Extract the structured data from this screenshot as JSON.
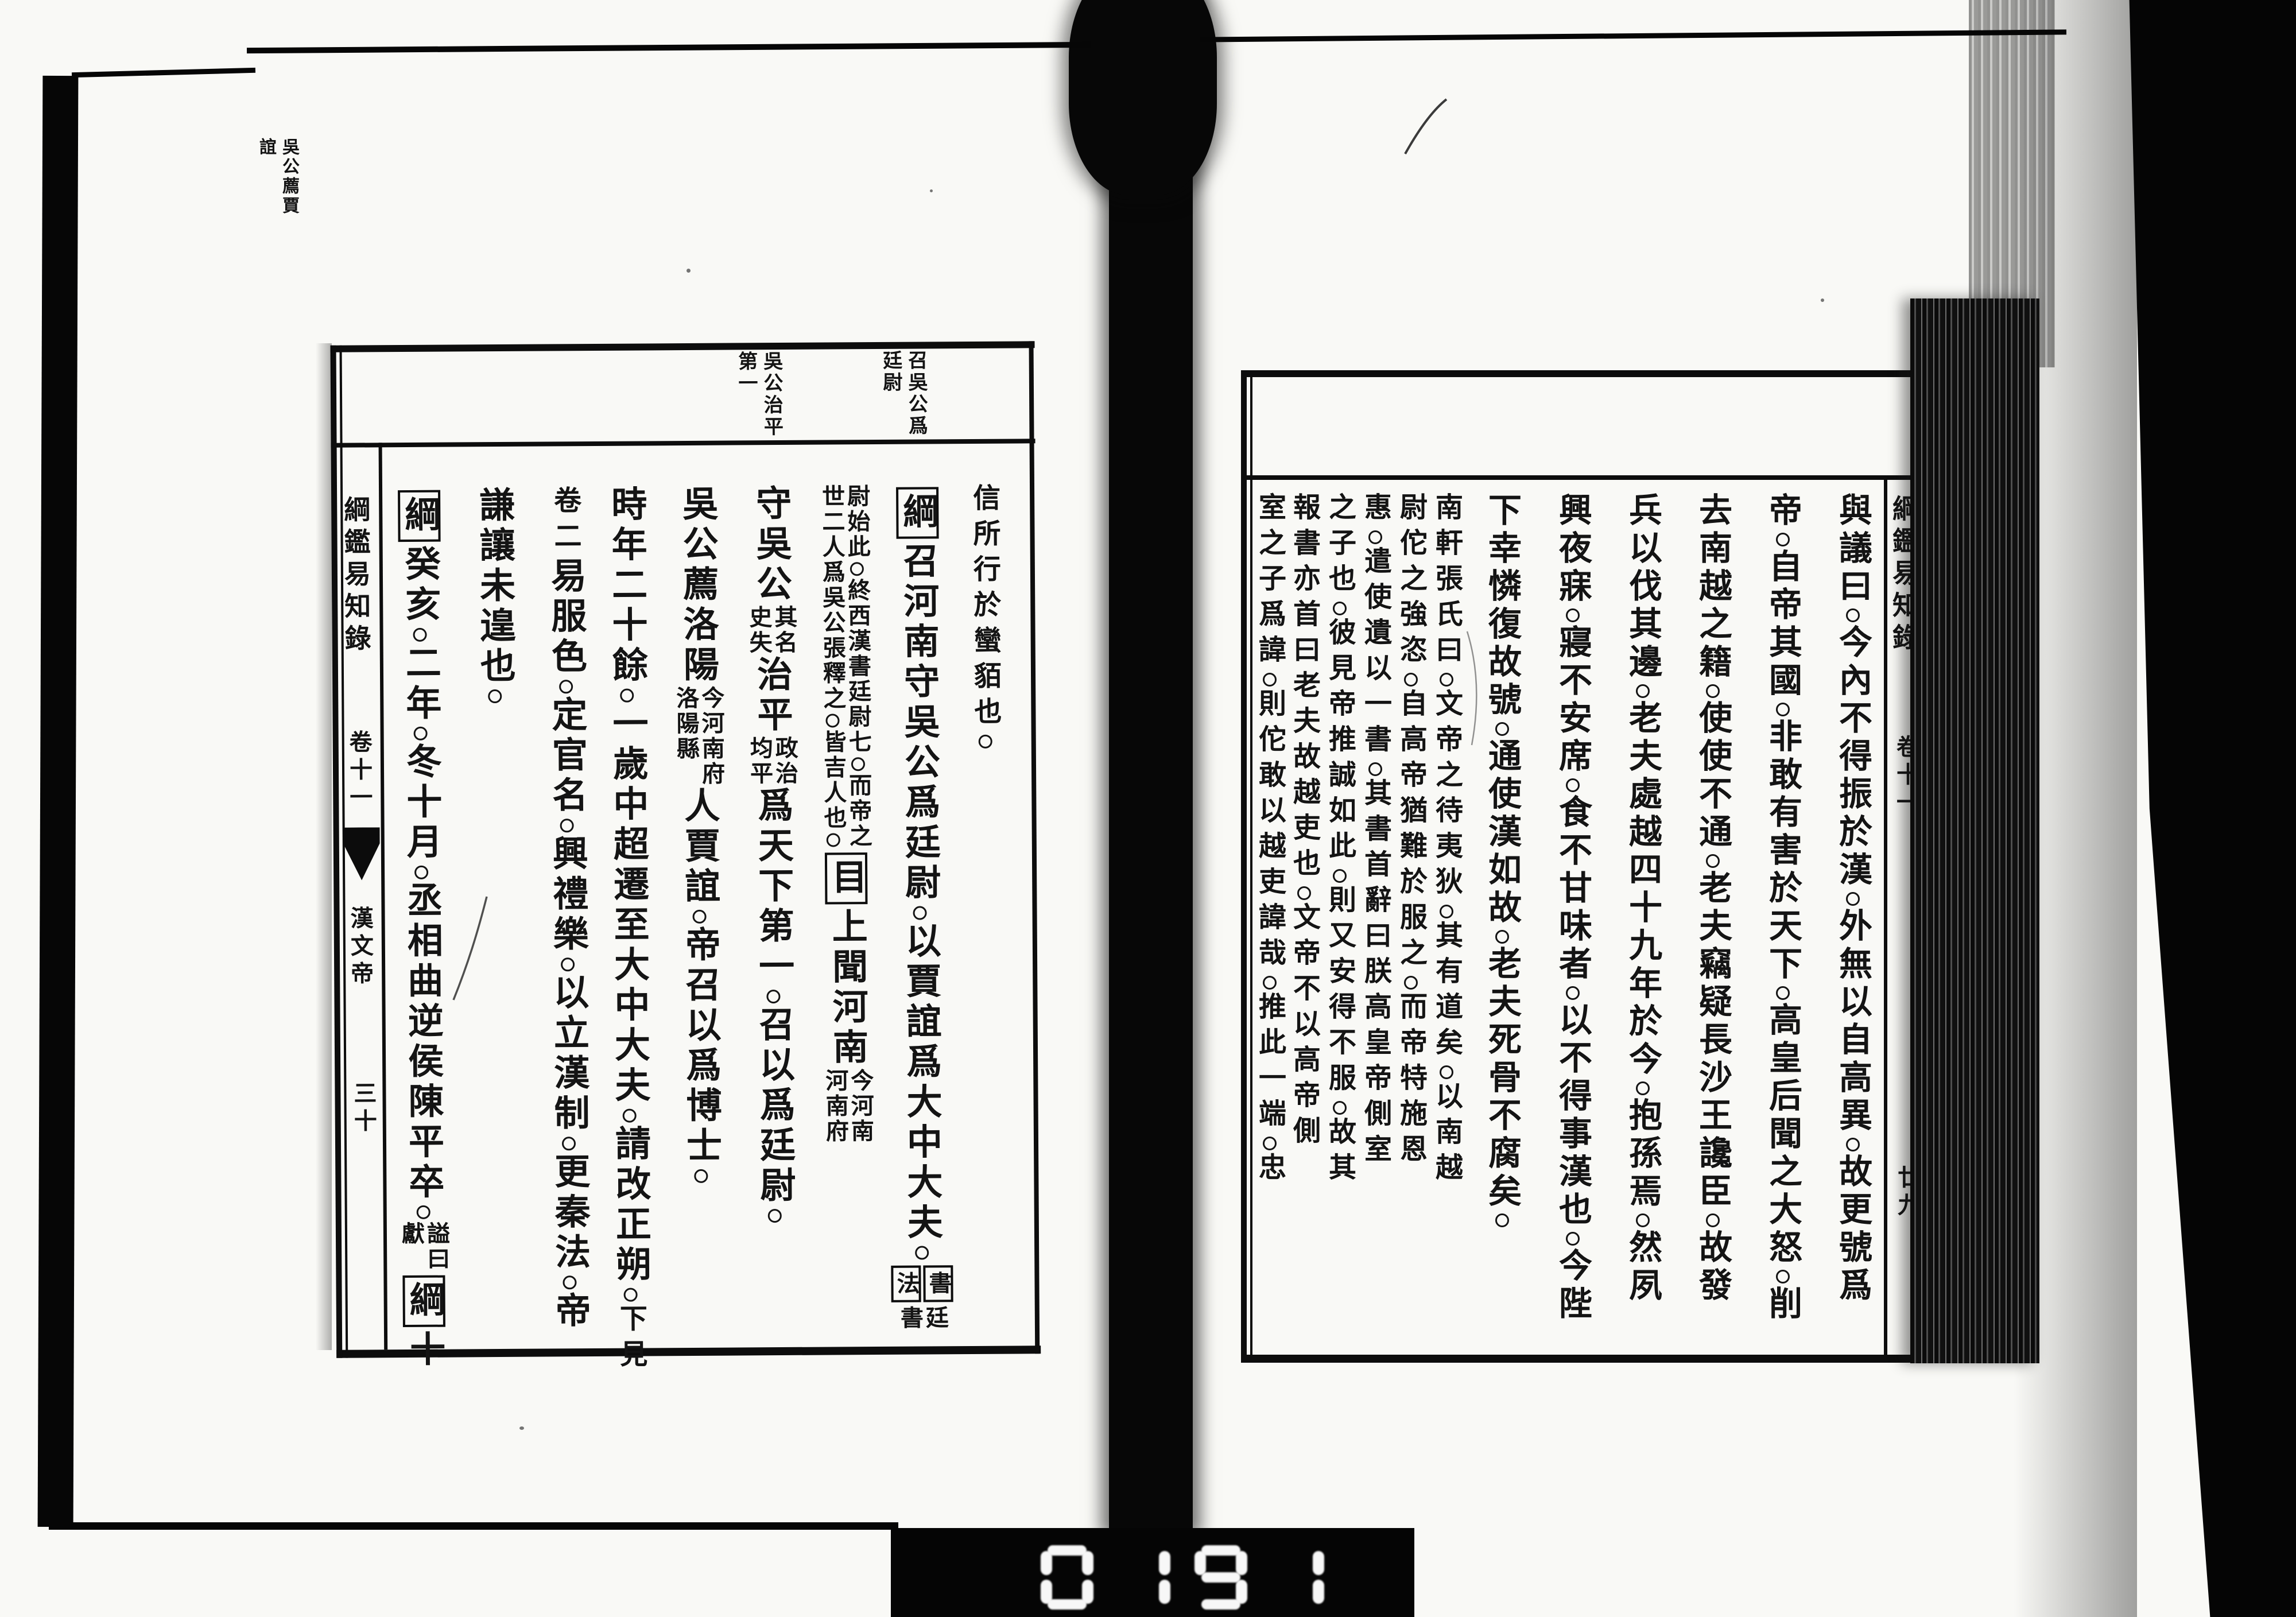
{
  "colors": {
    "ink": "#141414",
    "paper": "#f9f9f6",
    "film_black": "#060606"
  },
  "book_spread": {
    "left_page": {
      "spine": {
        "title": "綱鑑易知錄",
        "juan": "卷十一",
        "section": "漢文帝",
        "page_no": "三十"
      },
      "margin_notes": [
        {
          "cols": [
            "召吳公爲",
            "廷尉"
          ]
        },
        {
          "cols": [
            "吳公治平",
            "第一"
          ]
        }
      ],
      "floating_note": {
        "cols": [
          "吳公薦賈",
          "誼"
        ]
      },
      "columns": [
        {
          "parts": [
            {
              "type": "small",
              "text": "信所行於蠻貊也。"
            }
          ]
        },
        {
          "parts": [
            {
              "type": "box",
              "text": "綱"
            },
            {
              "type": "big",
              "text": "召河南守吳公爲廷尉。以賈誼爲大中大夫。"
            },
            {
              "type": "dblbox",
              "right": "書",
              "left": "法"
            },
            {
              "type": "dbl",
              "right": "廷",
              "left": "書"
            }
          ]
        },
        {
          "parts": [
            {
              "type": "dbl",
              "right": "尉始此。終西漢書廷尉七。而帝之",
              "left": "世二人爲吳公張釋之。皆吉人也。"
            },
            {
              "type": "box",
              "text": "目"
            },
            {
              "type": "big",
              "text": "上聞河南"
            },
            {
              "type": "dbl",
              "right": "今河南",
              "left": "河南府"
            }
          ]
        },
        {
          "parts": [
            {
              "type": "big",
              "text": "守吳公"
            },
            {
              "type": "dbl",
              "right": "其名",
              "left": "史失"
            },
            {
              "type": "big",
              "text": "治平"
            },
            {
              "type": "dbl",
              "right": "政治",
              "left": "均平"
            },
            {
              "type": "big",
              "text": "爲天下第一。召以爲廷尉。"
            }
          ]
        },
        {
          "parts": [
            {
              "type": "big",
              "text": "吳公薦洛陽"
            },
            {
              "type": "dbl",
              "right": "今河南府",
              "left": "洛陽縣"
            },
            {
              "type": "big",
              "text": "人賈誼。帝召以爲博士。"
            }
          ]
        },
        {
          "parts": [
            {
              "type": "big",
              "text": "時年二十餘。一歲中超遷至大中大夫。請改正朔。"
            },
            {
              "type": "small",
              "text": "下見"
            }
          ]
        },
        {
          "parts": [
            {
              "type": "small",
              "text": "卷二"
            },
            {
              "type": "big",
              "text": "易服色。定官名。興禮樂。以立漢制。更秦法。帝"
            }
          ]
        },
        {
          "parts": [
            {
              "type": "big",
              "text": "謙讓未遑也。"
            }
          ]
        },
        {
          "parts": [
            {
              "type": "box",
              "text": "綱"
            },
            {
              "type": "big",
              "text": "癸亥。二年。冬十月。丞相曲逆侯陳平卒。"
            },
            {
              "type": "dbl",
              "right": "謚曰",
              "left": "獻"
            },
            {
              "type": "box",
              "text": "綱"
            },
            {
              "type": "big",
              "text": "十"
            }
          ]
        }
      ]
    },
    "right_page": {
      "spine": {
        "title": "綱鑑易知錄",
        "juan": "卷十一",
        "page_no": "廿九"
      },
      "columns": [
        {
          "parts": [
            {
              "type": "big",
              "text": "與議曰。今內不得振於漢。外無以自高異。故更號爲"
            }
          ]
        },
        {
          "parts": [
            {
              "type": "big",
              "text": "帝。自帝其國。非敢有害於天下。高皇后聞之大怒。削"
            }
          ]
        },
        {
          "parts": [
            {
              "type": "big",
              "text": "去南越之籍。使使不通。老夫竊疑長沙王讒臣。故發"
            }
          ]
        },
        {
          "parts": [
            {
              "type": "big",
              "text": "兵以伐其邊。老夫處越四十九年於今。抱孫焉。然夙"
            }
          ]
        },
        {
          "parts": [
            {
              "type": "big",
              "text": "興夜寐。寢不安席。食不甘味者。以不得事漢也。今陛"
            }
          ]
        },
        {
          "parts": [
            {
              "type": "big",
              "text": "下幸憐復故號。通使漢如故。老夫死骨不腐矣。"
            }
          ]
        },
        {
          "parts": [
            {
              "type": "small",
              "text": "南軒張氏曰。文帝之待夷狄。其有道矣。以南越"
            }
          ]
        },
        {
          "parts": [
            {
              "type": "small",
              "text": "尉佗之強恣。自高帝猶難於服之。而帝特施恩"
            }
          ]
        },
        {
          "parts": [
            {
              "type": "small",
              "text": "惠。遣使遺以一書。其書首辭曰朕高皇帝側室"
            }
          ]
        },
        {
          "parts": [
            {
              "type": "small",
              "text": "之子也。彼見帝推誠如此。則又安得不服。故其"
            }
          ]
        },
        {
          "parts": [
            {
              "type": "small",
              "text": "報書亦首曰老夫故越吏也。文帝不以高帝側"
            }
          ]
        },
        {
          "parts": [
            {
              "type": "small",
              "text": "室之子爲諱。則佗敢以越吏諱哉。推此一端。忠"
            }
          ]
        }
      ]
    }
  },
  "film": {
    "frame_counter_digits": "0191"
  }
}
